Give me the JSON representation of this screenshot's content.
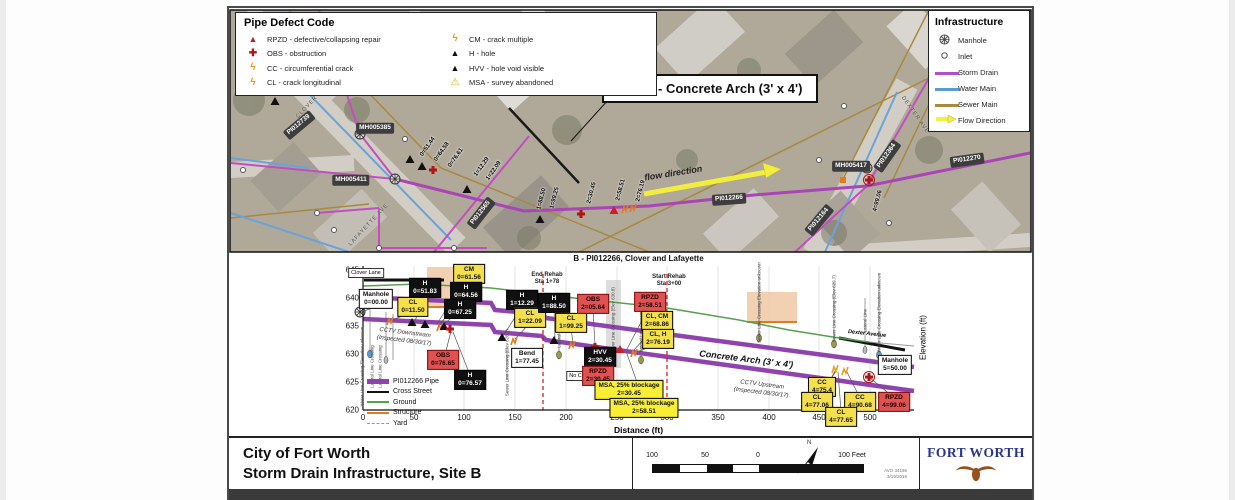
{
  "document": {
    "site_callout": "Site B - Concrete Arch (3' x 4')",
    "bottom_title_line1": "City of Fort Worth",
    "bottom_title_line2": "Storm Drain Infrastructure, Site B",
    "avo_number": "AVO 34186",
    "date": "3/19/2019",
    "logo_text": "FORT WORTH",
    "north_label": "N"
  },
  "scale_bar": {
    "tick_100_left": "100",
    "tick_50": "50",
    "tick_0": "0",
    "tick_100_right": "100 Feet"
  },
  "defect_legend": {
    "title": "Pipe Defect Code",
    "items": [
      {
        "code": "RPZD",
        "label": "RPZD - defective/collapsing repair",
        "icon": "red-triangle-icon",
        "color": "#c42121"
      },
      {
        "code": "OBS",
        "label": "OBS - obstruction",
        "icon": "red-cross-icon",
        "color": "#b11414"
      },
      {
        "code": "CC",
        "label": "CC - circumferential crack",
        "icon": "orange-crack-icon",
        "color": "#e09b1a"
      },
      {
        "code": "CL",
        "label": "CL - crack longitudinal",
        "icon": "orange-crack-icon",
        "color": "#e09b1a"
      },
      {
        "code": "CM",
        "label": "CM - crack multiple",
        "icon": "orange-crack-icon",
        "color": "#e09b1a"
      },
      {
        "code": "H",
        "label": "H - hole",
        "icon": "black-triangle-icon",
        "color": "#111111"
      },
      {
        "code": "HVV",
        "label": "HVV - hole void visible",
        "icon": "black-triangle-icon",
        "color": "#111111"
      },
      {
        "code": "MSA",
        "label": "MSA - survey abandoned",
        "icon": "warning-triangle-icon",
        "color": "#d8b500"
      }
    ]
  },
  "infra_legend": {
    "title": "Infrastructure",
    "items": [
      {
        "label": "Manhole",
        "icon": "manhole-icon"
      },
      {
        "label": "Inlet",
        "icon": "inlet-icon"
      },
      {
        "label": "Storm Drain",
        "icon": "line-swatch",
        "color": "#b050c8"
      },
      {
        "label": "Water Main",
        "icon": "line-swatch",
        "color": "#5b9bd5"
      },
      {
        "label": "Sewer Main",
        "icon": "line-swatch",
        "color": "#a8893d"
      },
      {
        "label": "Flow Direction",
        "icon": "flow-arrow-icon",
        "color": "#f3ef45"
      }
    ]
  },
  "map": {
    "flow_label": "flow direction",
    "streets": [
      {
        "name": "CLOVER LN"
      },
      {
        "name": "LAFAYETTE AVE"
      },
      {
        "name": "DEXTER AVE"
      }
    ],
    "assets": [
      {
        "id": "PI012739"
      },
      {
        "id": "MH005385"
      },
      {
        "id": "MH005411"
      },
      {
        "id": "PI012565"
      },
      {
        "id": "PI012266"
      },
      {
        "id": "PI012164"
      },
      {
        "id": "PI012364"
      },
      {
        "id": "MH005417"
      },
      {
        "id": "PI012270"
      }
    ],
    "stations": [
      {
        "s": "0=51.44"
      },
      {
        "s": "0=64.58"
      },
      {
        "s": "0=76.61"
      },
      {
        "s": "1=12.29"
      },
      {
        "s": "1=22.09"
      },
      {
        "s": "1=88.50"
      },
      {
        "s": "1=99.25"
      },
      {
        "s": "2=30.45"
      },
      {
        "s": "2=58.51"
      },
      {
        "s": "2=76.19"
      },
      {
        "s": "4=99.06"
      }
    ]
  },
  "chart": {
    "title": "B - PI012266, Clover and Lafayette",
    "xlabel": "Distance (ft)",
    "ylabel": "Elevation (ft)",
    "y_ticks": [
      "645",
      "640",
      "635",
      "630",
      "625",
      "620"
    ],
    "x_ticks": [
      "0",
      "50",
      "100",
      "150",
      "200",
      "250",
      "300",
      "350",
      "400",
      "450",
      "500"
    ],
    "legend": [
      {
        "label": "PI012266 Pipe"
      },
      {
        "label": "Cross Street"
      },
      {
        "label": "Ground"
      },
      {
        "label": "Structure"
      },
      {
        "label": "Yard"
      }
    ],
    "rehab": {
      "end_line1": "End Rehab",
      "end_line2": "Sta 1+78",
      "start_line1": "Start Rehab",
      "start_line2": "Sta 3+00"
    },
    "cctv_down_line1": "CCTV Downstream",
    "cctv_down_line2": "(Inspected 08/30/17)",
    "cctv_up_line1": "CCTV Upstream",
    "cctv_up_line2": "(Inspected 08/30/17)",
    "arch_label": "Concrete Arch (3' x 4')",
    "no_cctv": "No CCTV",
    "clover_lane": "Clover Lane",
    "dexter_avenue": "Dexter Avenue",
    "labels": [
      {
        "code": "Manhole",
        "station": "0=00.00"
      },
      {
        "code": "CL",
        "station": "0=11.50"
      },
      {
        "code": "H",
        "station": "0=51.83"
      },
      {
        "code": "CM",
        "station": "0=61.56"
      },
      {
        "code": "H",
        "station": "0=64.56"
      },
      {
        "code": "H",
        "station": "0=67.25"
      },
      {
        "code": "OBS",
        "station": "0=76.65"
      },
      {
        "code": "H",
        "station": "0=76.57"
      },
      {
        "code": "Bend",
        "station": "1=77.45"
      },
      {
        "code": "H",
        "station": "1=12.29"
      },
      {
        "code": "CL",
        "station": "1=22.09"
      },
      {
        "code": "H",
        "station": "1=88.50"
      },
      {
        "code": "CL",
        "station": "1=99.25"
      },
      {
        "code": "OBS",
        "station": "2=05.64"
      },
      {
        "code": "HVV",
        "station": "2=30.45"
      },
      {
        "code": "RPZD",
        "station": "2=30.45"
      },
      {
        "code": "MSA, 25% blockage",
        "station": "2=30.45"
      },
      {
        "code": "MSA, 25% blockage",
        "station": "2=58.51"
      },
      {
        "code": "RPZD",
        "station": "2=58.51"
      },
      {
        "code": "CL, CM",
        "station": "2=68.86"
      },
      {
        "code": "CL, H",
        "station": "2=76.19"
      },
      {
        "code": "CC",
        "station": "4=75.4"
      },
      {
        "code": "CL",
        "station": "4=77.06"
      },
      {
        "code": "CC",
        "station": "4=90.68"
      },
      {
        "code": "CL",
        "station": "4=77.65"
      },
      {
        "code": "RPZD",
        "station": "4=99.06"
      },
      {
        "code": "Manhole",
        "station": "5=50.00"
      }
    ],
    "crossings": [
      {
        "text": "Water Line Crossing Elevation unknown"
      },
      {
        "text": "Lateral Line Crossing"
      },
      {
        "text": "Lateral Line Crossing"
      },
      {
        "text": "Sewer Line Crossing (Elev 628.7)"
      },
      {
        "text": "Lateral Line Crossing"
      },
      {
        "text": "Sewer Line Crossing (Elev 630.8)"
      },
      {
        "text": "Lateral Line Crossing"
      },
      {
        "text": "Sewer Line Crossing Elevation unknown"
      },
      {
        "text": "Sewer Line Crossing (Elev 629.7)"
      },
      {
        "text": "Lateral Line"
      },
      {
        "text": "Water Line Crossing Elevation unknown"
      }
    ]
  },
  "chart_data": {
    "type": "line",
    "title": "B - PI012266, Clover and Lafayette",
    "xlabel": "Distance (ft)",
    "ylabel": "Elevation (ft)",
    "xlim": [
      0,
      540
    ],
    "ylim": [
      620,
      645
    ],
    "grid": true,
    "legend_position": "lower left",
    "series": [
      {
        "name": "Ground",
        "x": [
          0,
          55,
          126,
          208,
          300,
          371,
          420,
          469,
          543
        ],
        "values": [
          642.1,
          642.5,
          641.8,
          640.0,
          638.2,
          636.1,
          634.3,
          632.9,
          631.4
        ]
      },
      {
        "name": "PI012266 Pipe (top of pipe)",
        "x": [
          0,
          543
        ],
        "values": [
          640.4,
          627.9
        ]
      },
      {
        "name": "PI012266 Pipe (bottom of pipe)",
        "x": [
          0,
          543
        ],
        "values": [
          636.4,
          623.6
        ]
      }
    ],
    "events": [
      {
        "station_ft": 0,
        "label": "Manhole"
      },
      {
        "station_ft": 11.5,
        "label": "CL"
      },
      {
        "station_ft": 51.83,
        "label": "H"
      },
      {
        "station_ft": 61.56,
        "label": "CM"
      },
      {
        "station_ft": 64.56,
        "label": "H"
      },
      {
        "station_ft": 67.25,
        "label": "H"
      },
      {
        "station_ft": 76.57,
        "label": "H"
      },
      {
        "station_ft": 76.65,
        "label": "OBS"
      },
      {
        "station_ft": 112.29,
        "label": "H"
      },
      {
        "station_ft": 122.09,
        "label": "CL"
      },
      {
        "station_ft": 177.45,
        "label": "Bend"
      },
      {
        "station_ft": 178,
        "label": "End Rehab"
      },
      {
        "station_ft": 188.5,
        "label": "H"
      },
      {
        "station_ft": 199.25,
        "label": "CL"
      },
      {
        "station_ft": 205.64,
        "label": "OBS"
      },
      {
        "station_ft": 230.45,
        "label": "HVV + RPZD + MSA 25% blockage"
      },
      {
        "station_ft": 258.51,
        "label": "RPZD + MSA 25% blockage"
      },
      {
        "station_ft": 268.86,
        "label": "CL, CM"
      },
      {
        "station_ft": 276.19,
        "label": "CL, H"
      },
      {
        "station_ft": 300,
        "label": "Start Rehab"
      },
      {
        "station_ft": 475.4,
        "label": "CC"
      },
      {
        "station_ft": 477.06,
        "label": "CL"
      },
      {
        "station_ft": 477.65,
        "label": "CL"
      },
      {
        "station_ft": 490.68,
        "label": "CC"
      },
      {
        "station_ft": 499.06,
        "label": "RPZD"
      },
      {
        "station_ft": 550,
        "label": "Manhole"
      }
    ]
  }
}
